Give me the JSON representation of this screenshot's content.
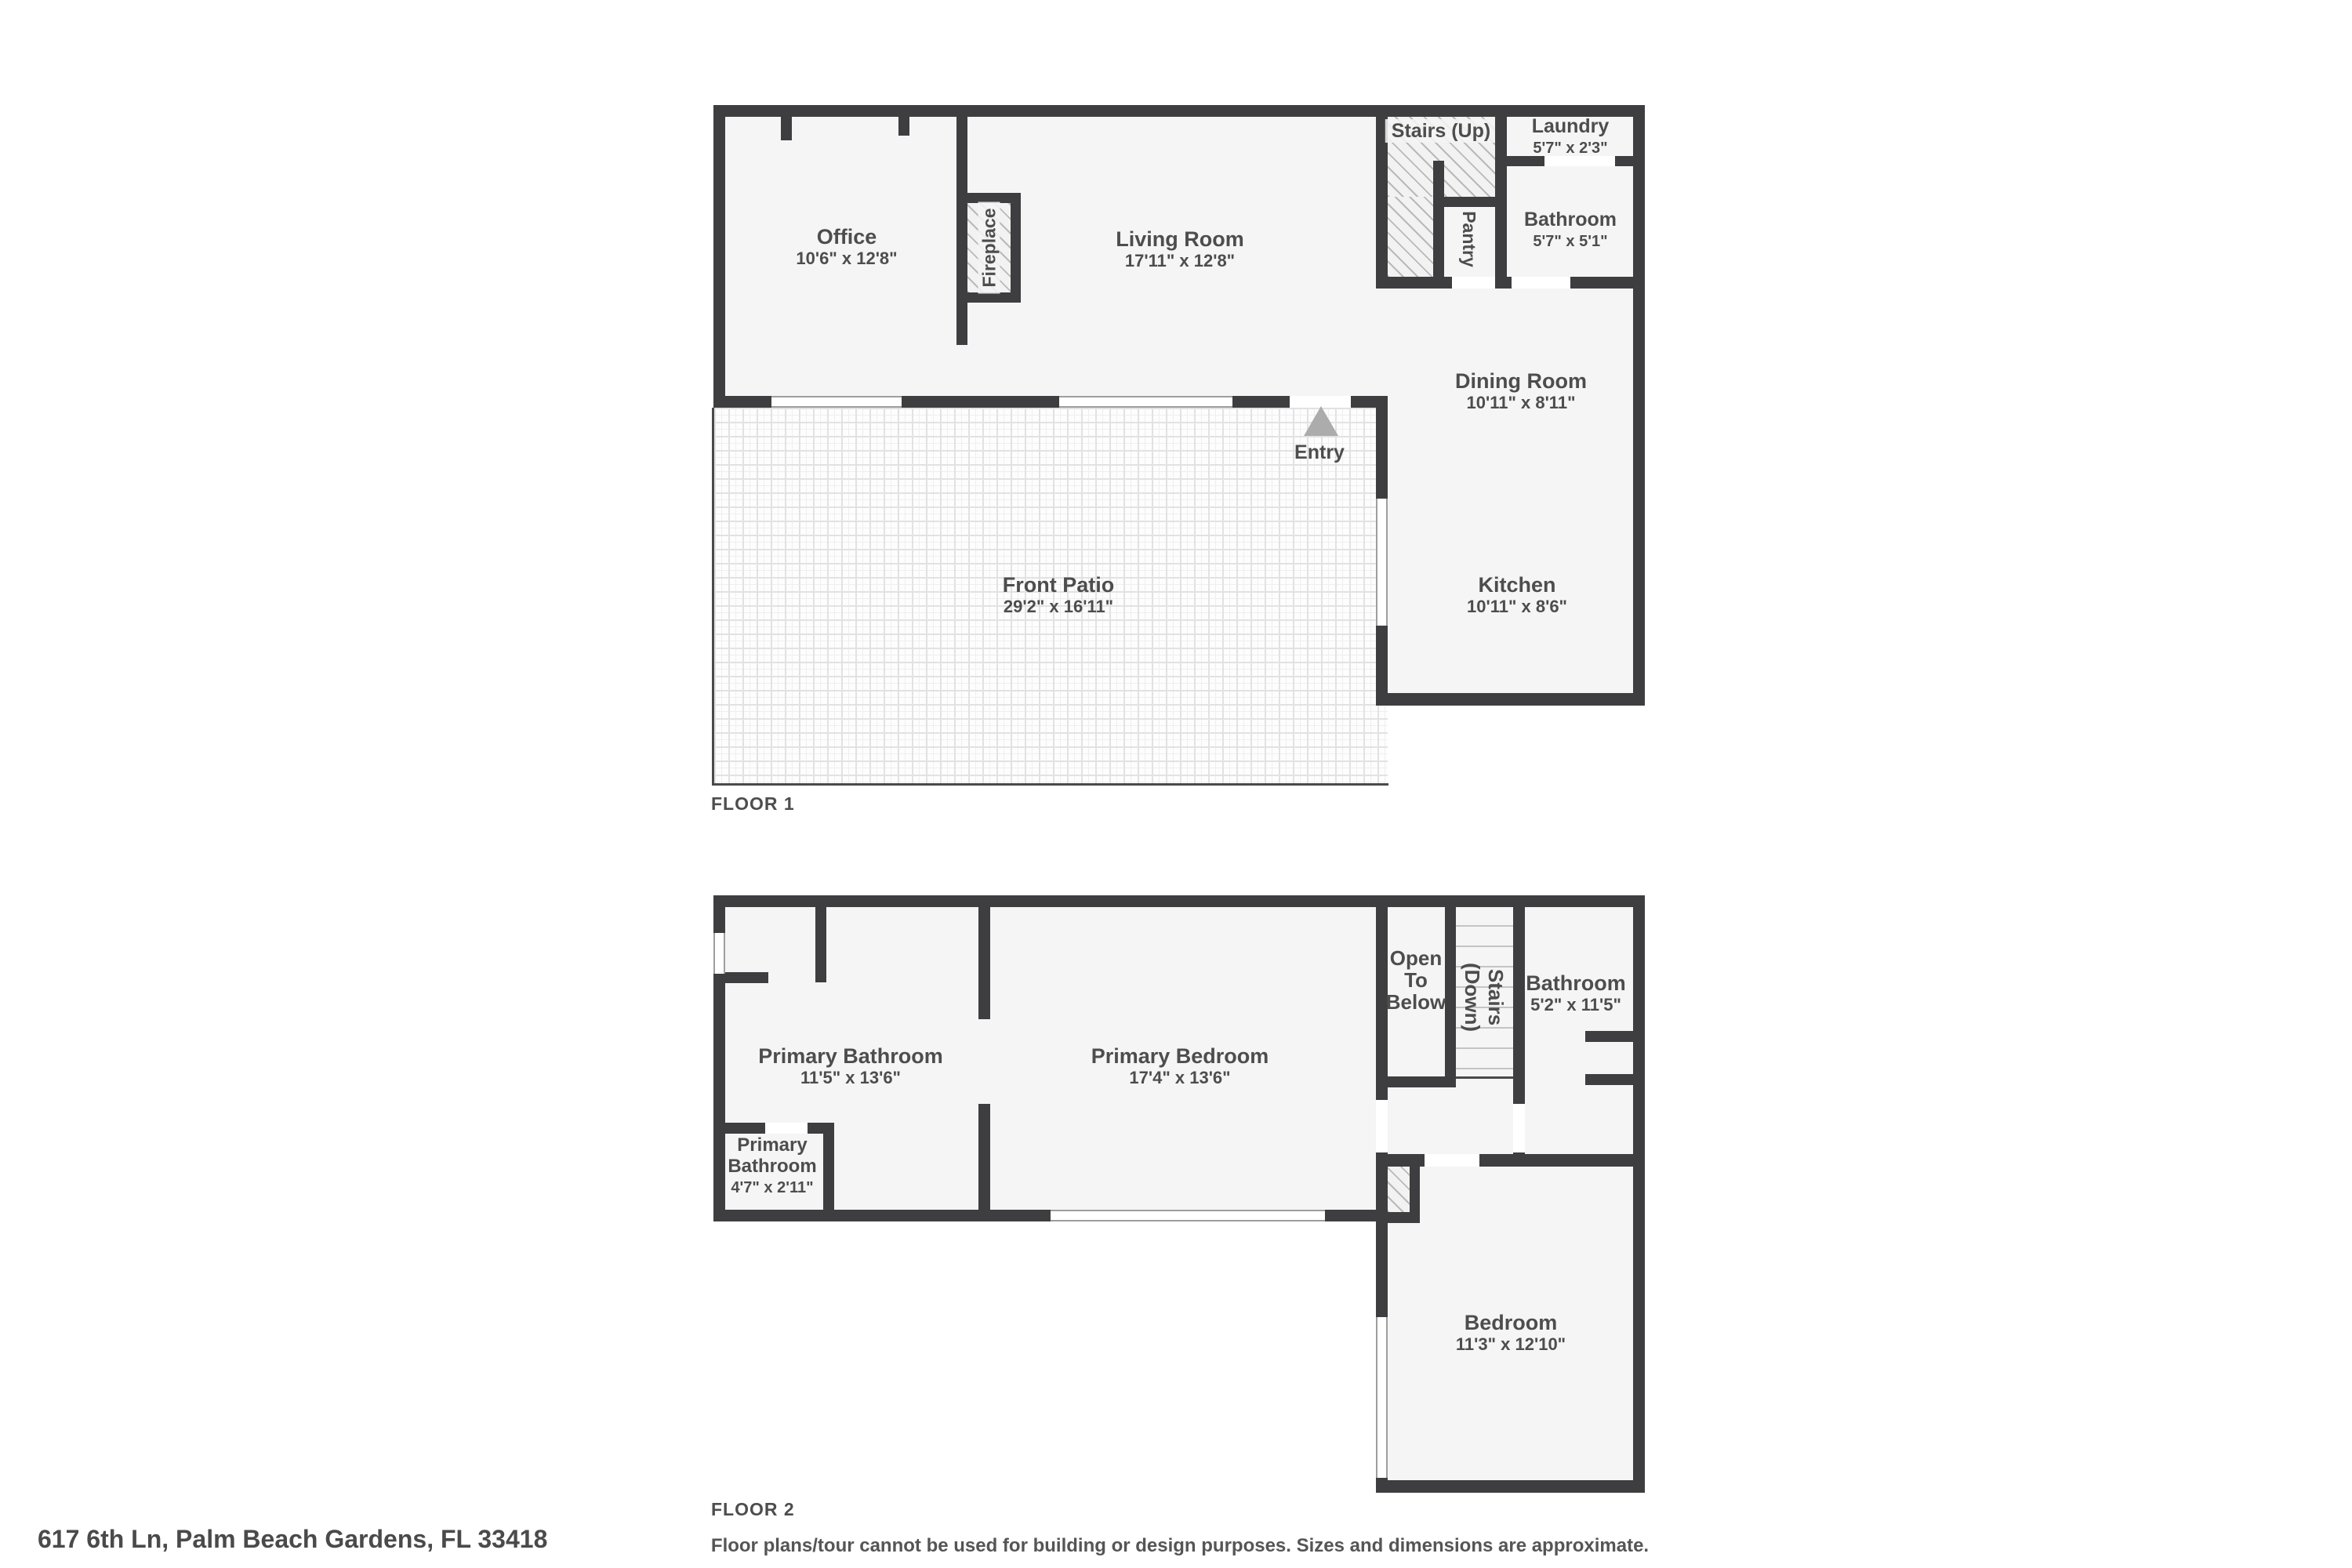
{
  "floor1": {
    "title": "FLOOR 1",
    "office_name": "Office",
    "office_dims": "10'6\" x 12'8\"",
    "living_name": "Living Room",
    "living_dims": "17'11\" x 12'8\"",
    "stairs_label": "Stairs (Up)",
    "pantry_label": "Pantry",
    "fireplace_label": "Fireplace",
    "laundry_name": "Laundry",
    "laundry_dims": "5'7\" x 2'3\"",
    "bathroom_name": "Bathroom",
    "bathroom_dims": "5'7\" x 5'1\"",
    "dining_name": "Dining Room",
    "dining_dims": "10'11\" x 8'11\"",
    "kitchen_name": "Kitchen",
    "kitchen_dims": "10'11\" x 8'6\"",
    "patio_name": "Front Patio",
    "patio_dims": "29'2\" x 16'11\"",
    "entry_label": "Entry"
  },
  "floor2": {
    "title": "FLOOR 2",
    "pbath_name": "Primary Bathroom",
    "pbath_dims": "11'5\" x 13'6\"",
    "pbed_name": "Primary Bedroom",
    "pbed_dims": "17'4\" x 13'6\"",
    "small_bath_line1": "Primary",
    "small_bath_line2": "Bathroom",
    "small_bath_dims": "4'7\" x 2'11\"",
    "otb_line1": "Open",
    "otb_line2": "To",
    "otb_line3": "Below",
    "stairs_line1": "Stairs",
    "stairs_line2": "(Down)",
    "bath_name": "Bathroom",
    "bath_dims": "5'2\" x 11'5\"",
    "bedroom_name": "Bedroom",
    "bedroom_dims": "11'3\" x 12'10\""
  },
  "footer": {
    "address": "617 6th Ln, Palm Beach Gardens, FL 33418",
    "disclaimer": "Floor plans/tour cannot be used for building or design purposes. Sizes and dimensions are approximate."
  },
  "colors": {
    "wall": "#3e3e40",
    "floor": "#f5f5f5",
    "text": "#4d4d4d",
    "entry_arrow": "#acacac"
  }
}
